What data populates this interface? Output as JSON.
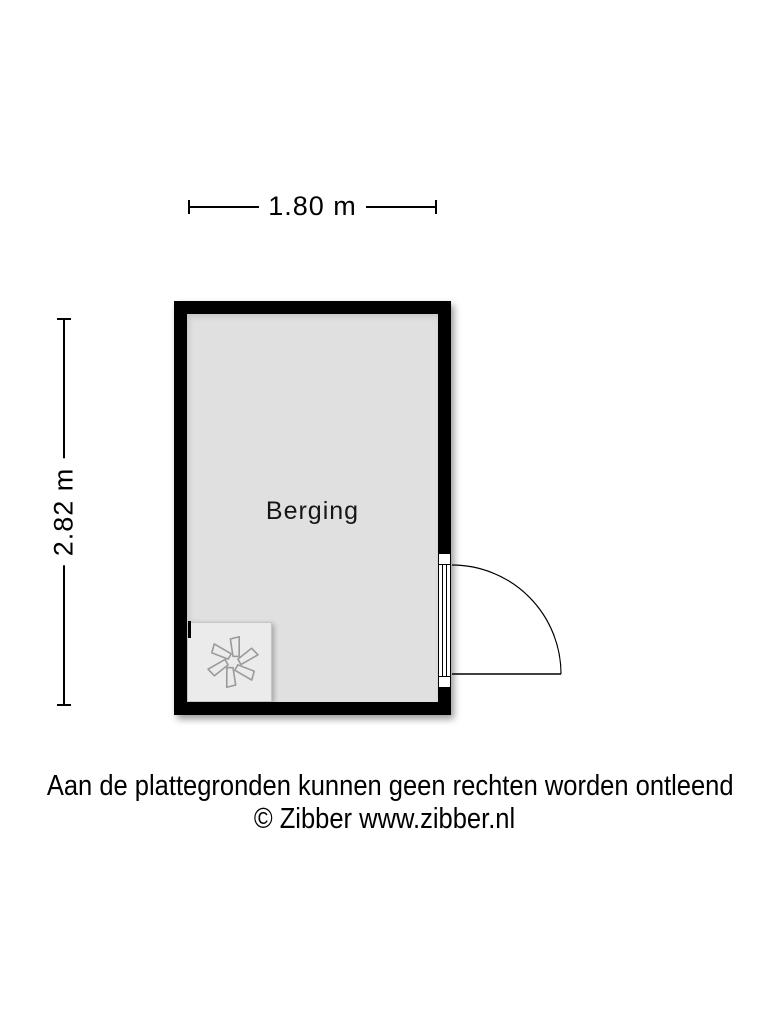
{
  "dimensions": {
    "top_width": "1.80 m",
    "left_height": "2.82 m"
  },
  "room": {
    "name": "Berging"
  },
  "appliance": {
    "type": "mechanical-ventilation-unit",
    "icon": "fan-icon"
  },
  "door": {
    "type": "single-swing-door",
    "wall": "right",
    "swing": "outward"
  },
  "footer": {
    "disclaimer": "Aan de plattegronden kunnen geen rechten worden ontleend",
    "credit": "© Zibber www.zibber.nl"
  },
  "colors": {
    "wall": "#000000",
    "floor": "#e0e0e0",
    "appliance_fill": "#ebebeb",
    "fan_stroke": "#9a9a9a",
    "line": "#000000"
  }
}
